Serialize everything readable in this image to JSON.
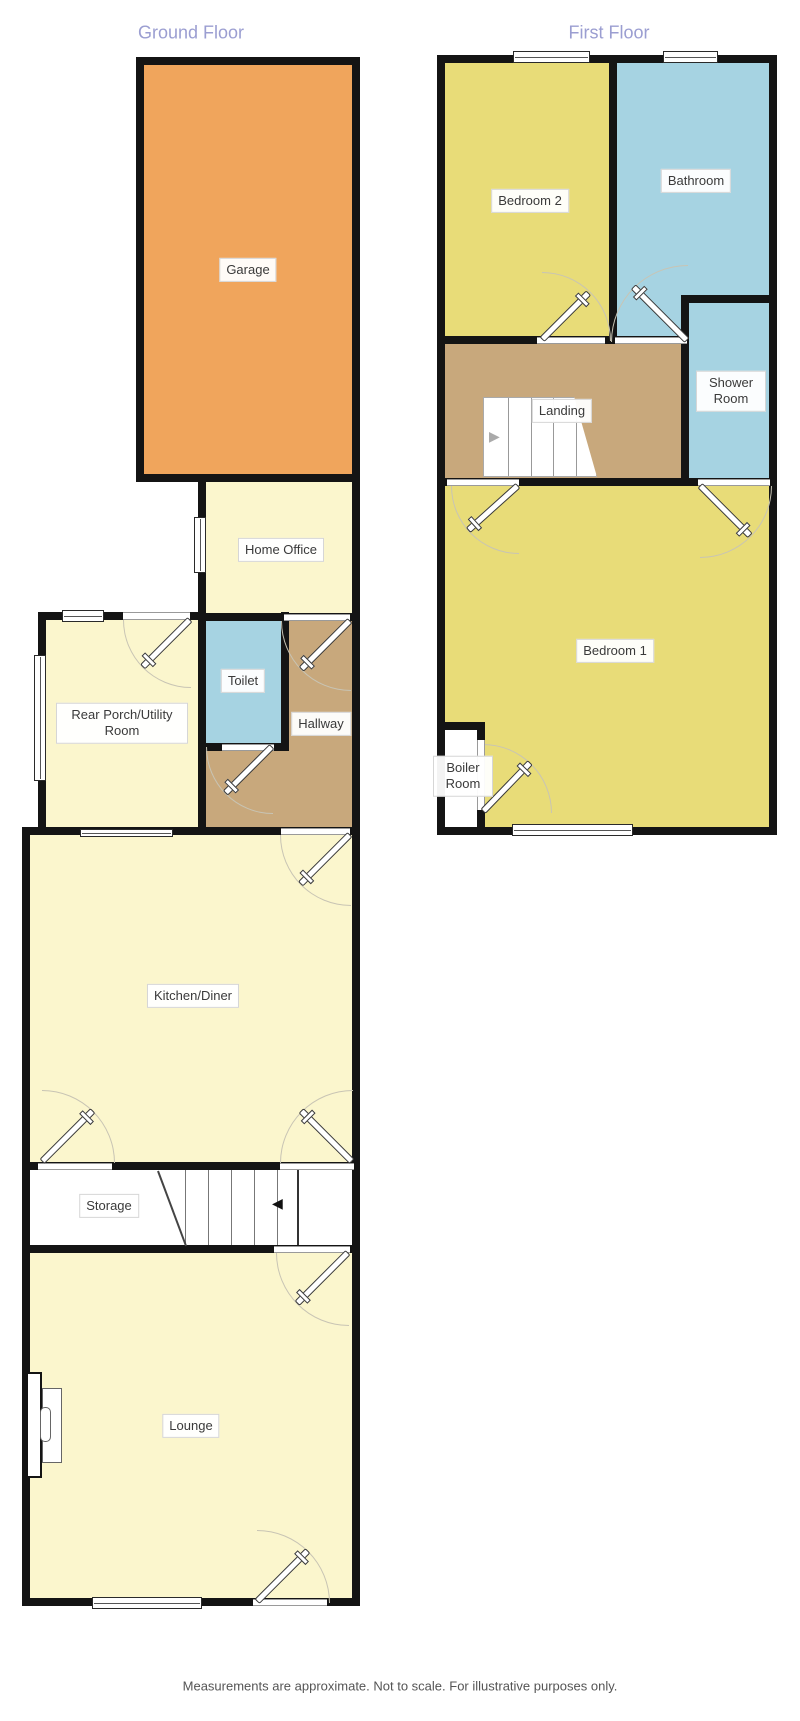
{
  "disclaimer": "Measurements are approximate. Not to scale. For illustrative purposes only.",
  "ground_floor": {
    "title": "Ground Floor",
    "rooms": [
      {
        "label": "Garage"
      },
      {
        "label": "Home Office"
      },
      {
        "label": "Rear Porch/Utility Room"
      },
      {
        "label": "Toilet"
      },
      {
        "label": "Hallway"
      },
      {
        "label": "Kitchen/Diner"
      },
      {
        "label": "Storage"
      },
      {
        "label": "Lounge"
      }
    ]
  },
  "first_floor": {
    "title": "First Floor",
    "rooms": [
      {
        "label": "Bedroom 2"
      },
      {
        "label": "Bathroom"
      },
      {
        "label": "Shower Room"
      },
      {
        "label": "Landing"
      },
      {
        "label": "Bedroom 1"
      },
      {
        "label": "Boiler Room"
      }
    ]
  },
  "icons": {
    "stairs_down_arrow": "◀",
    "stairs_up_arrow": "▶"
  },
  "colors": {
    "wall": "#141414",
    "garage": "#f0a55c",
    "bedroom_yellow": "#e8dc78",
    "bathroom_blue": "#a6d3e2",
    "cream": "#fbf6cd",
    "hall_brown": "#c8a87c",
    "title_text": "#9b9ed1",
    "label_text": "#3a3a3a",
    "disclaimer_text": "#555555",
    "arc": "#c8c4b4"
  }
}
